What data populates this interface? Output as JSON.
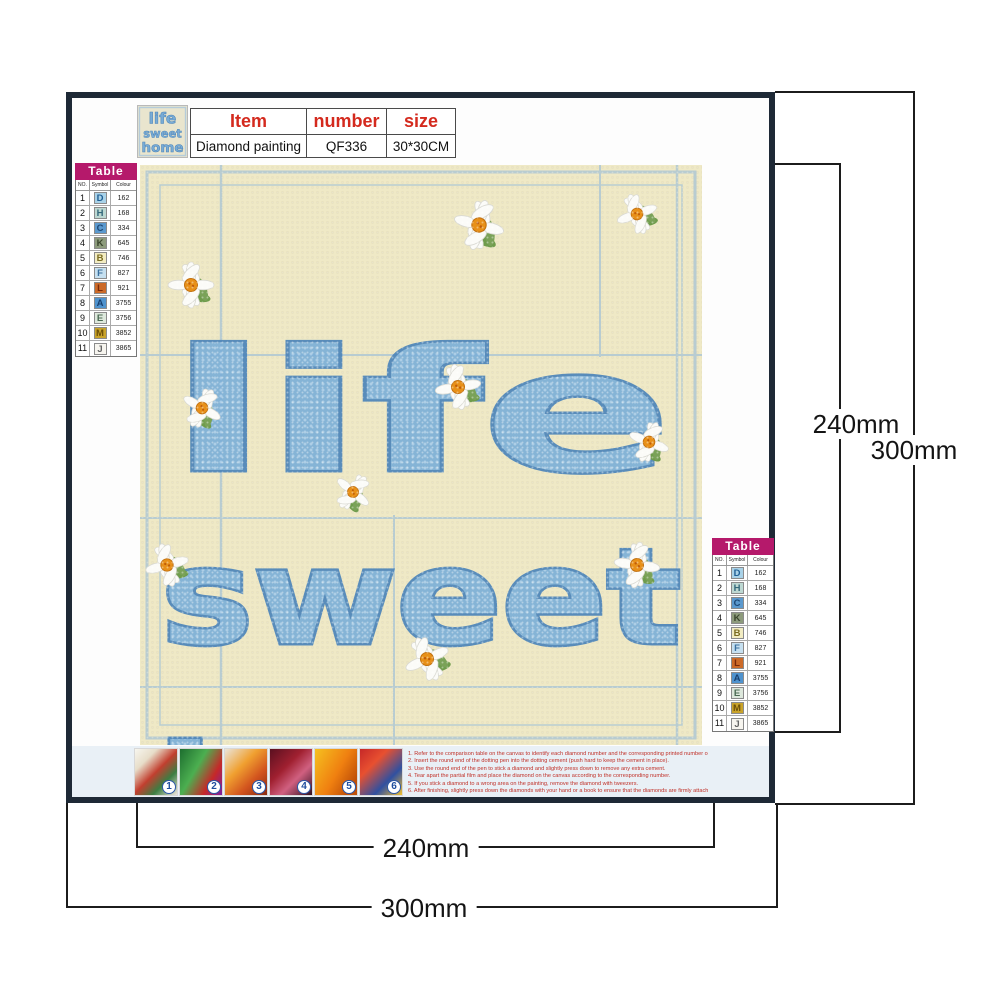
{
  "header_table": {
    "columns": [
      "Item",
      "number",
      "size"
    ],
    "values": [
      "Diamond painting",
      "QF336",
      "30*30CM"
    ]
  },
  "legend": {
    "title": "Table",
    "columns": [
      "NO.",
      "Symbol",
      "Colour"
    ],
    "rows": [
      {
        "no": "1",
        "symbol": "D",
        "color_num": "162",
        "bg": "#a9d2e8",
        "fg": "#1f5f94"
      },
      {
        "no": "2",
        "symbol": "H",
        "color_num": "168",
        "bg": "#bdd8d2",
        "fg": "#33687a"
      },
      {
        "no": "3",
        "symbol": "C",
        "color_num": "334",
        "bg": "#5b99ce",
        "fg": "#1d4875"
      },
      {
        "no": "4",
        "symbol": "K",
        "color_num": "645",
        "bg": "#8d9b7c",
        "fg": "#39452c"
      },
      {
        "no": "5",
        "symbol": "B",
        "color_num": "746",
        "bg": "#f2ecc2",
        "fg": "#7a6c20"
      },
      {
        "no": "6",
        "symbol": "F",
        "color_num": "827",
        "bg": "#c6e0f0",
        "fg": "#3a6f9e"
      },
      {
        "no": "7",
        "symbol": "L",
        "color_num": "921",
        "bg": "#cc6a28",
        "fg": "#78290a"
      },
      {
        "no": "8",
        "symbol": "A",
        "color_num": "3755",
        "bg": "#4f93ce",
        "fg": "#173f6e"
      },
      {
        "no": "9",
        "symbol": "E",
        "color_num": "3756",
        "bg": "#dde8dc",
        "fg": "#4a6a52"
      },
      {
        "no": "10",
        "symbol": "M",
        "color_num": "3852",
        "bg": "#c9a32a",
        "fg": "#6a4e08"
      },
      {
        "no": "11",
        "symbol": "J",
        "color_num": "3865",
        "bg": "#f7f5ef",
        "fg": "#666666"
      }
    ]
  },
  "artwork": {
    "words": [
      "life",
      "sweet",
      "home"
    ],
    "canvas_bg": "#efe9c6",
    "word_fill": "#7db0d8",
    "word_outline": "#4e86ba",
    "daisy_center": "#e89018"
  },
  "steps": {
    "numbers": [
      "1",
      "2",
      "3",
      "4",
      "5",
      "6"
    ],
    "instructions": [
      "1. Refer to the comparison table on the canvas to identify each diamond number and the corresponding printed number on the canvas.",
      "2. Insert the round end of the dotting pen into the dotting cement (push hard to keep the cement in place).",
      "3. Use the round end of the pen to stick a diamond and slightly press down to remove any extra cement.",
      "4. Tear apart the partial film and place the diamond on the canvas according to the corresponding number.",
      "5. If you stick a diamond to a wrong area on the painting, remove the diamond with tweezers.",
      "6. After finishing, slightly press down the diamonds with your hand or a book to ensure that the diamonds are firmly attached."
    ]
  },
  "dimensions": {
    "right_inner": "240mm",
    "right_outer": "300mm",
    "bottom_inner": "240mm",
    "bottom_outer": "300mm"
  }
}
